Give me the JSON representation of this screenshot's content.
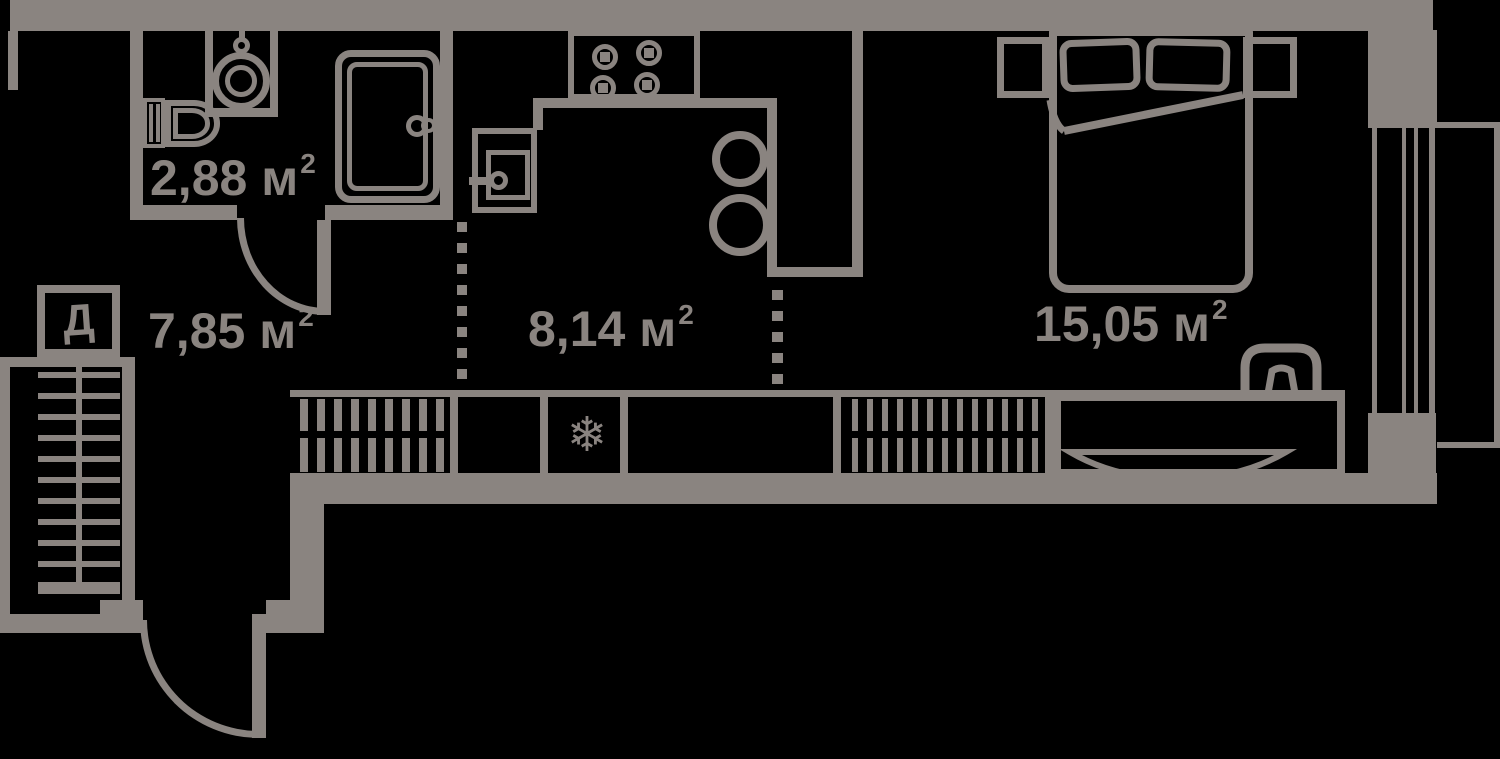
{
  "colors": {
    "wall": "#8a8480",
    "background": "#000000"
  },
  "rooms": {
    "bathroom": {
      "area": "2,88",
      "unit": " м",
      "sup": "2"
    },
    "hallway": {
      "area": "7,85",
      "unit": " м",
      "sup": "2"
    },
    "kitchen": {
      "area": "8,14",
      "unit": " м",
      "sup": "2"
    },
    "bedroom": {
      "area": "15,05",
      "unit": " м",
      "sup": "2"
    }
  },
  "icons": {
    "utility_shaft_label": "Д",
    "refrigerator_snowflake": "❄"
  }
}
